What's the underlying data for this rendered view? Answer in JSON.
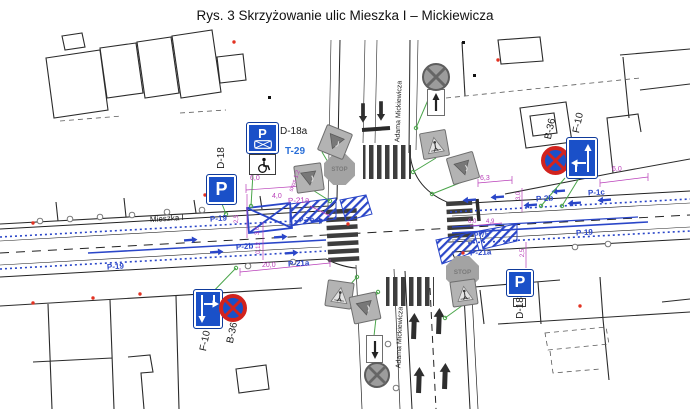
{
  "title": "Rys. 3 Skrzyżowanie ulic Mieszka I – Mickiewicza",
  "streets": {
    "horizontal": "Mieszka I",
    "vertical": "Adama Mickiewicza"
  },
  "colors": {
    "sign_blue": "#1a50c8",
    "marking_blue": "#2a46c8",
    "dimension_magenta": "#b93fb9",
    "existing_gray": "#9c9c9c",
    "prohibition_red": "#d2231e",
    "leader_green": "#4aa54a"
  },
  "signs": {
    "d18_west": {
      "code": "D-18",
      "letter": "P"
    },
    "d18a": {
      "code": "D-18a",
      "letter": "P"
    },
    "t29": {
      "code": "T-29"
    },
    "d18_se": {
      "code": "D-18",
      "letter": "P"
    },
    "b36_ne": {
      "code": "B-36"
    },
    "b36_sw": {
      "code": "B-36"
    },
    "f10_ne": {
      "code": "F-10"
    },
    "f10_sw": {
      "code": "F-10"
    },
    "stop": {
      "text": "STOP"
    }
  },
  "labels": [
    {
      "id": "street-mieszka-i",
      "t": "Mieszka I",
      "x": 150,
      "y": 215,
      "rot": -4,
      "c": "ink",
      "fs": 8
    },
    {
      "id": "street-mickiewicza-north",
      "t": "Adama Mickiewicza",
      "x": 349,
      "y": 108,
      "rot": -88,
      "c": "ink",
      "fs": 7,
      "w": 100
    },
    {
      "id": "street-mickiewicza-south",
      "t": "Adama Mickiewicza",
      "x": 350,
      "y": 334,
      "rot": -88,
      "c": "ink",
      "fs": 7,
      "w": 100
    },
    {
      "id": "sign-label-d18-west",
      "t": "D-18",
      "x": 206,
      "y": 153,
      "rot": -90,
      "c": "ink",
      "fs": 10,
      "w": 32
    },
    {
      "id": "sign-label-d18a",
      "t": "D-18a",
      "x": 280,
      "y": 127,
      "c": "ink",
      "fs": 10
    },
    {
      "id": "sign-label-t29",
      "t": "T-29",
      "x": 285,
      "y": 147,
      "c": "blu2",
      "fs": 10
    },
    {
      "id": "sign-label-b36-ne",
      "t": "B-36",
      "x": 536,
      "y": 124,
      "rot": -78,
      "c": "ink",
      "fs": 10,
      "w": 30
    },
    {
      "id": "sign-label-f10-ne",
      "t": "F-10",
      "x": 564,
      "y": 118,
      "rot": -78,
      "c": "ink",
      "fs": 10,
      "w": 30
    },
    {
      "id": "sign-label-b36-sw",
      "t": "B-36",
      "x": 218,
      "y": 328,
      "rot": -78,
      "c": "ink",
      "fs": 10,
      "w": 30
    },
    {
      "id": "sign-label-f10-sw",
      "t": "F-10",
      "x": 191,
      "y": 336,
      "rot": -78,
      "c": "ink",
      "fs": 10,
      "w": 30
    },
    {
      "id": "sign-label-d18-se",
      "t": "D-18",
      "x": 505,
      "y": 303,
      "rot": -90,
      "c": "ink",
      "fs": 10,
      "w": 32
    },
    {
      "t": "P-19",
      "x": 210,
      "y": 215,
      "rot": -4,
      "c": "blu",
      "fs": 8
    },
    {
      "t": "P-19",
      "x": 107,
      "y": 263,
      "rot": -4,
      "c": "blu",
      "fs": 8
    },
    {
      "t": "P-19",
      "x": 576,
      "y": 229,
      "rot": -3,
      "c": "blu",
      "fs": 8
    },
    {
      "t": "P-2b",
      "x": 236,
      "y": 243,
      "rot": -4,
      "c": "blu",
      "fs": 8
    },
    {
      "t": "P-2b",
      "x": 536,
      "y": 195,
      "rot": -3,
      "c": "blu",
      "fs": 8
    },
    {
      "t": "P-1c",
      "x": 588,
      "y": 189,
      "rot": -3,
      "c": "blu",
      "fs": 8
    },
    {
      "t": "P-7b",
      "x": 299,
      "y": 217,
      "rot": -4,
      "c": "blu",
      "fs": 7
    },
    {
      "t": "P-7b",
      "x": 474,
      "y": 232,
      "rot": -3,
      "c": "blu",
      "fs": 7
    },
    {
      "t": "P-21a",
      "x": 288,
      "y": 260,
      "rot": -3,
      "c": "blu",
      "fs": 8
    },
    {
      "t": "P-21a",
      "x": 470,
      "y": 249,
      "rot": -3,
      "c": "blu",
      "fs": 8
    },
    {
      "t": "P-21a",
      "x": 288,
      "y": 197,
      "rot": -3,
      "c": "mag",
      "fs": 8
    },
    {
      "t": "6,0",
      "x": 250,
      "y": 175,
      "c": "mag",
      "fs": 7
    },
    {
      "t": "4,0",
      "x": 272,
      "y": 193,
      "c": "mag",
      "fs": 7
    },
    {
      "t": "20,0",
      "x": 262,
      "y": 262,
      "c": "mag",
      "fs": 7
    },
    {
      "t": "skos 1:2",
      "x": 284,
      "y": 178,
      "rot": -70,
      "c": "mag",
      "fs": 6
    },
    {
      "t": "2,5",
      "x": 233,
      "y": 216,
      "rot": -90,
      "c": "mag",
      "fs": 6
    },
    {
      "t": "3,0",
      "x": 254,
      "y": 228,
      "rot": -90,
      "c": "mag",
      "fs": 6
    },
    {
      "t": "0,12",
      "x": 253,
      "y": 245,
      "rot": -90,
      "c": "mag",
      "fs": 6
    },
    {
      "t": "6,3",
      "x": 480,
      "y": 175,
      "c": "mag",
      "fs": 7
    },
    {
      "t": "6,0",
      "x": 612,
      "y": 166,
      "c": "mag",
      "fs": 7
    },
    {
      "t": "3,0",
      "x": 515,
      "y": 193,
      "rot": -90,
      "c": "mag",
      "fs": 6
    },
    {
      "t": "2,5",
      "x": 519,
      "y": 250,
      "rot": -90,
      "c": "mag",
      "fs": 6
    },
    {
      "t": "6,0",
      "x": 468,
      "y": 219,
      "c": "mag",
      "fs": 6
    },
    {
      "t": "4,9",
      "x": 486,
      "y": 219,
      "c": "mag",
      "fs": 6
    }
  ],
  "blue_arrows": [
    {
      "x": 190,
      "y": 240,
      "r": -4
    },
    {
      "x": 216,
      "y": 252,
      "r": -4
    },
    {
      "x": 280,
      "y": 237,
      "r": -4
    },
    {
      "x": 291,
      "y": 253,
      "r": -4
    },
    {
      "x": 317,
      "y": 221,
      "r": -4
    },
    {
      "x": 470,
      "y": 200,
      "r": 176
    },
    {
      "x": 498,
      "y": 197,
      "r": 176
    },
    {
      "x": 531,
      "y": 205,
      "r": 176
    },
    {
      "x": 559,
      "y": 191,
      "r": 176
    },
    {
      "x": 575,
      "y": 203,
      "r": 176
    },
    {
      "x": 605,
      "y": 200,
      "r": 176
    }
  ],
  "black_arrows": [
    {
      "x": 414,
      "y": 326,
      "r": 2,
      "s": 1
    },
    {
      "x": 439,
      "y": 321,
      "r": 2,
      "s": 1
    },
    {
      "x": 419,
      "y": 380,
      "r": 2,
      "s": 1
    },
    {
      "x": 445,
      "y": 376,
      "r": 2,
      "s": 1
    },
    {
      "x": 363,
      "y": 113,
      "r": 180,
      "s": 0.75
    },
    {
      "x": 381,
      "y": 111,
      "r": 180,
      "s": 0.75
    }
  ],
  "utility_circles": [
    [
      40,
      221
    ],
    [
      70,
      219
    ],
    [
      100,
      217
    ],
    [
      132,
      215
    ],
    [
      167,
      212
    ],
    [
      202,
      210
    ],
    [
      248,
      266
    ],
    [
      293,
      262
    ],
    [
      575,
      247
    ],
    [
      608,
      244
    ],
    [
      388,
      344
    ],
    [
      396,
      388
    ]
  ],
  "red_dots": [
    [
      33,
      223
    ],
    [
      33,
      303
    ],
    [
      93,
      298
    ],
    [
      140,
      294
    ],
    [
      234,
      42
    ],
    [
      498,
      60
    ],
    [
      463,
      253
    ],
    [
      580,
      306
    ],
    [
      205,
      195
    ],
    [
      348,
      224
    ]
  ],
  "black_dots": [
    [
      473,
      74
    ],
    [
      268,
      96
    ],
    [
      462,
      41
    ]
  ],
  "green_leaders": [
    [
      253,
      173,
      251,
      206
    ],
    [
      565,
      178,
      541,
      206
    ],
    [
      584,
      170,
      562,
      206
    ],
    [
      222,
      204,
      226,
      214
    ],
    [
      207,
      298,
      236,
      268
    ],
    [
      436,
      158,
      413,
      172
    ],
    [
      462,
      182,
      432,
      194
    ],
    [
      340,
      296,
      357,
      277
    ],
    [
      367,
      312,
      378,
      292
    ],
    [
      463,
      305,
      445,
      318
    ],
    [
      322,
      152,
      338,
      179
    ],
    [
      300,
      182,
      330,
      201
    ],
    [
      428,
      100,
      416,
      128
    ],
    [
      374,
      336,
      376,
      318
    ]
  ]
}
